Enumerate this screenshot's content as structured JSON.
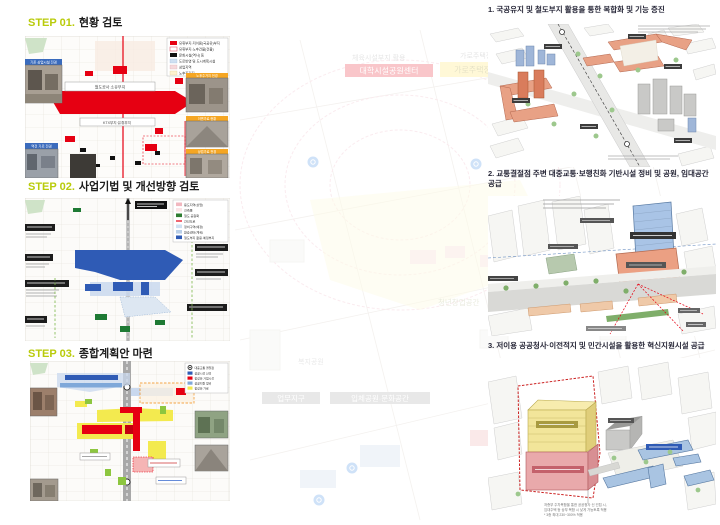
{
  "page": {
    "background": "#ffffff"
  },
  "steps": [
    {
      "label": "STEP 01.",
      "title": "현황 검토"
    },
    {
      "label": "STEP 02.",
      "title": "사업기법 및 개선방향 검토"
    },
    {
      "label": "STEP 03.",
      "title": "종합계획안 마련"
    }
  ],
  "sections": [
    {
      "title": "1. 국공유지 및 철도부지 활용을 통한 복합화 및 기능 증진"
    },
    {
      "title": "2. 교통결절점 주변 대중교통·보행친화 기반시설 정비 및 공원, 임대공간 공급"
    },
    {
      "title": "3. 저이용 공공청사·이전적지 및 민간시설을 활용한 혁신지원시설 공급"
    }
  ],
  "map1": {
    "legend": [
      {
        "label": "유휴부지·저이용(국공유)부지",
        "color": "#e60012"
      },
      {
        "label": "유휴부지·노후건물(건물)",
        "color": "#ffffff"
      },
      {
        "label": "문화시설(역사) 등",
        "color": "#111111"
      },
      {
        "label": "도로반영 및 도시계획시설",
        "color": "#cfe0f2"
      },
      {
        "label": "상업지역",
        "color": "#f6d9dc"
      },
      {
        "label": "노후주거지",
        "color": "#fdf3cf"
      }
    ],
    "site_top": "철도공사 소유부지",
    "site_bottom": "KTX부지·유휴부지",
    "photo_left_top": "기존 상업시설 전경",
    "photo_left_bottom": "역전 가로 전경",
    "photo_right_1": "노후주거지 전경",
    "photo_right_2": "이면가로 현황",
    "photo_right_3": "상업가로 전경"
  },
  "map2": {
    "legend": [
      {
        "label": "용도지역(상업)",
        "color": "#f2b8c0"
      },
      {
        "label": "건축물",
        "color": "#fbe3e6"
      },
      {
        "label": "철도 공원화",
        "color": "#2e7d32"
      },
      {
        "label": "간선도로",
        "color": "#e60012"
      },
      {
        "label": "정비구역(예정)",
        "color": "#cfe0f2"
      },
      {
        "label": "환승센터(계획)",
        "color": "#b9cfe8"
      },
      {
        "label": "철도부지 활용·예정부지",
        "color": "#2f5bb5"
      }
    ]
  },
  "map3": {
    "legend": [
      {
        "label": "대중교통 결절점",
        "symbol": "◉"
      },
      {
        "label": "공공시설 신설",
        "color": "#2f5bb5"
      },
      {
        "label": "활성화 거점시설",
        "color": "#e60012"
      },
      {
        "label": "공공지원 정비",
        "color": "#7fa8d9"
      },
      {
        "label": "활성화 가로",
        "color": "#f3ea4f"
      }
    ]
  },
  "diagram3": {
    "caption_line1": "저층부 주차복합을 통한 공공청사 신 건립 시,",
    "caption_line2": "임대주택 등 상부 복합 시 낮게 가능토록 적용",
    "caption_line3": "* 3종 최대 230~300% 적용"
  },
  "watermark": {
    "red_box": "대학시설공원센터",
    "yellow_box": "가로주택정비 연계거점",
    "note_left": "체육시설부지 활용",
    "note_right": "가로주택정비",
    "label_district": "업무지구",
    "label_park": "입체공원·문화공간",
    "label_youth": "청년창업공간",
    "label_welfare": "복지공원"
  },
  "colors": {
    "accent_lime": "#b9cb0b",
    "map_red": "#e60012",
    "map_blue": "#2f5bb5",
    "map_yellow": "#f3ea4f",
    "diagram_salmon": "#e8a185",
    "diagram_blue": "#a9c4e2",
    "diagram_yellow": "#f2e59a",
    "diagram_pink": "#e9a9ab",
    "legend_orange": "#f5a623"
  }
}
